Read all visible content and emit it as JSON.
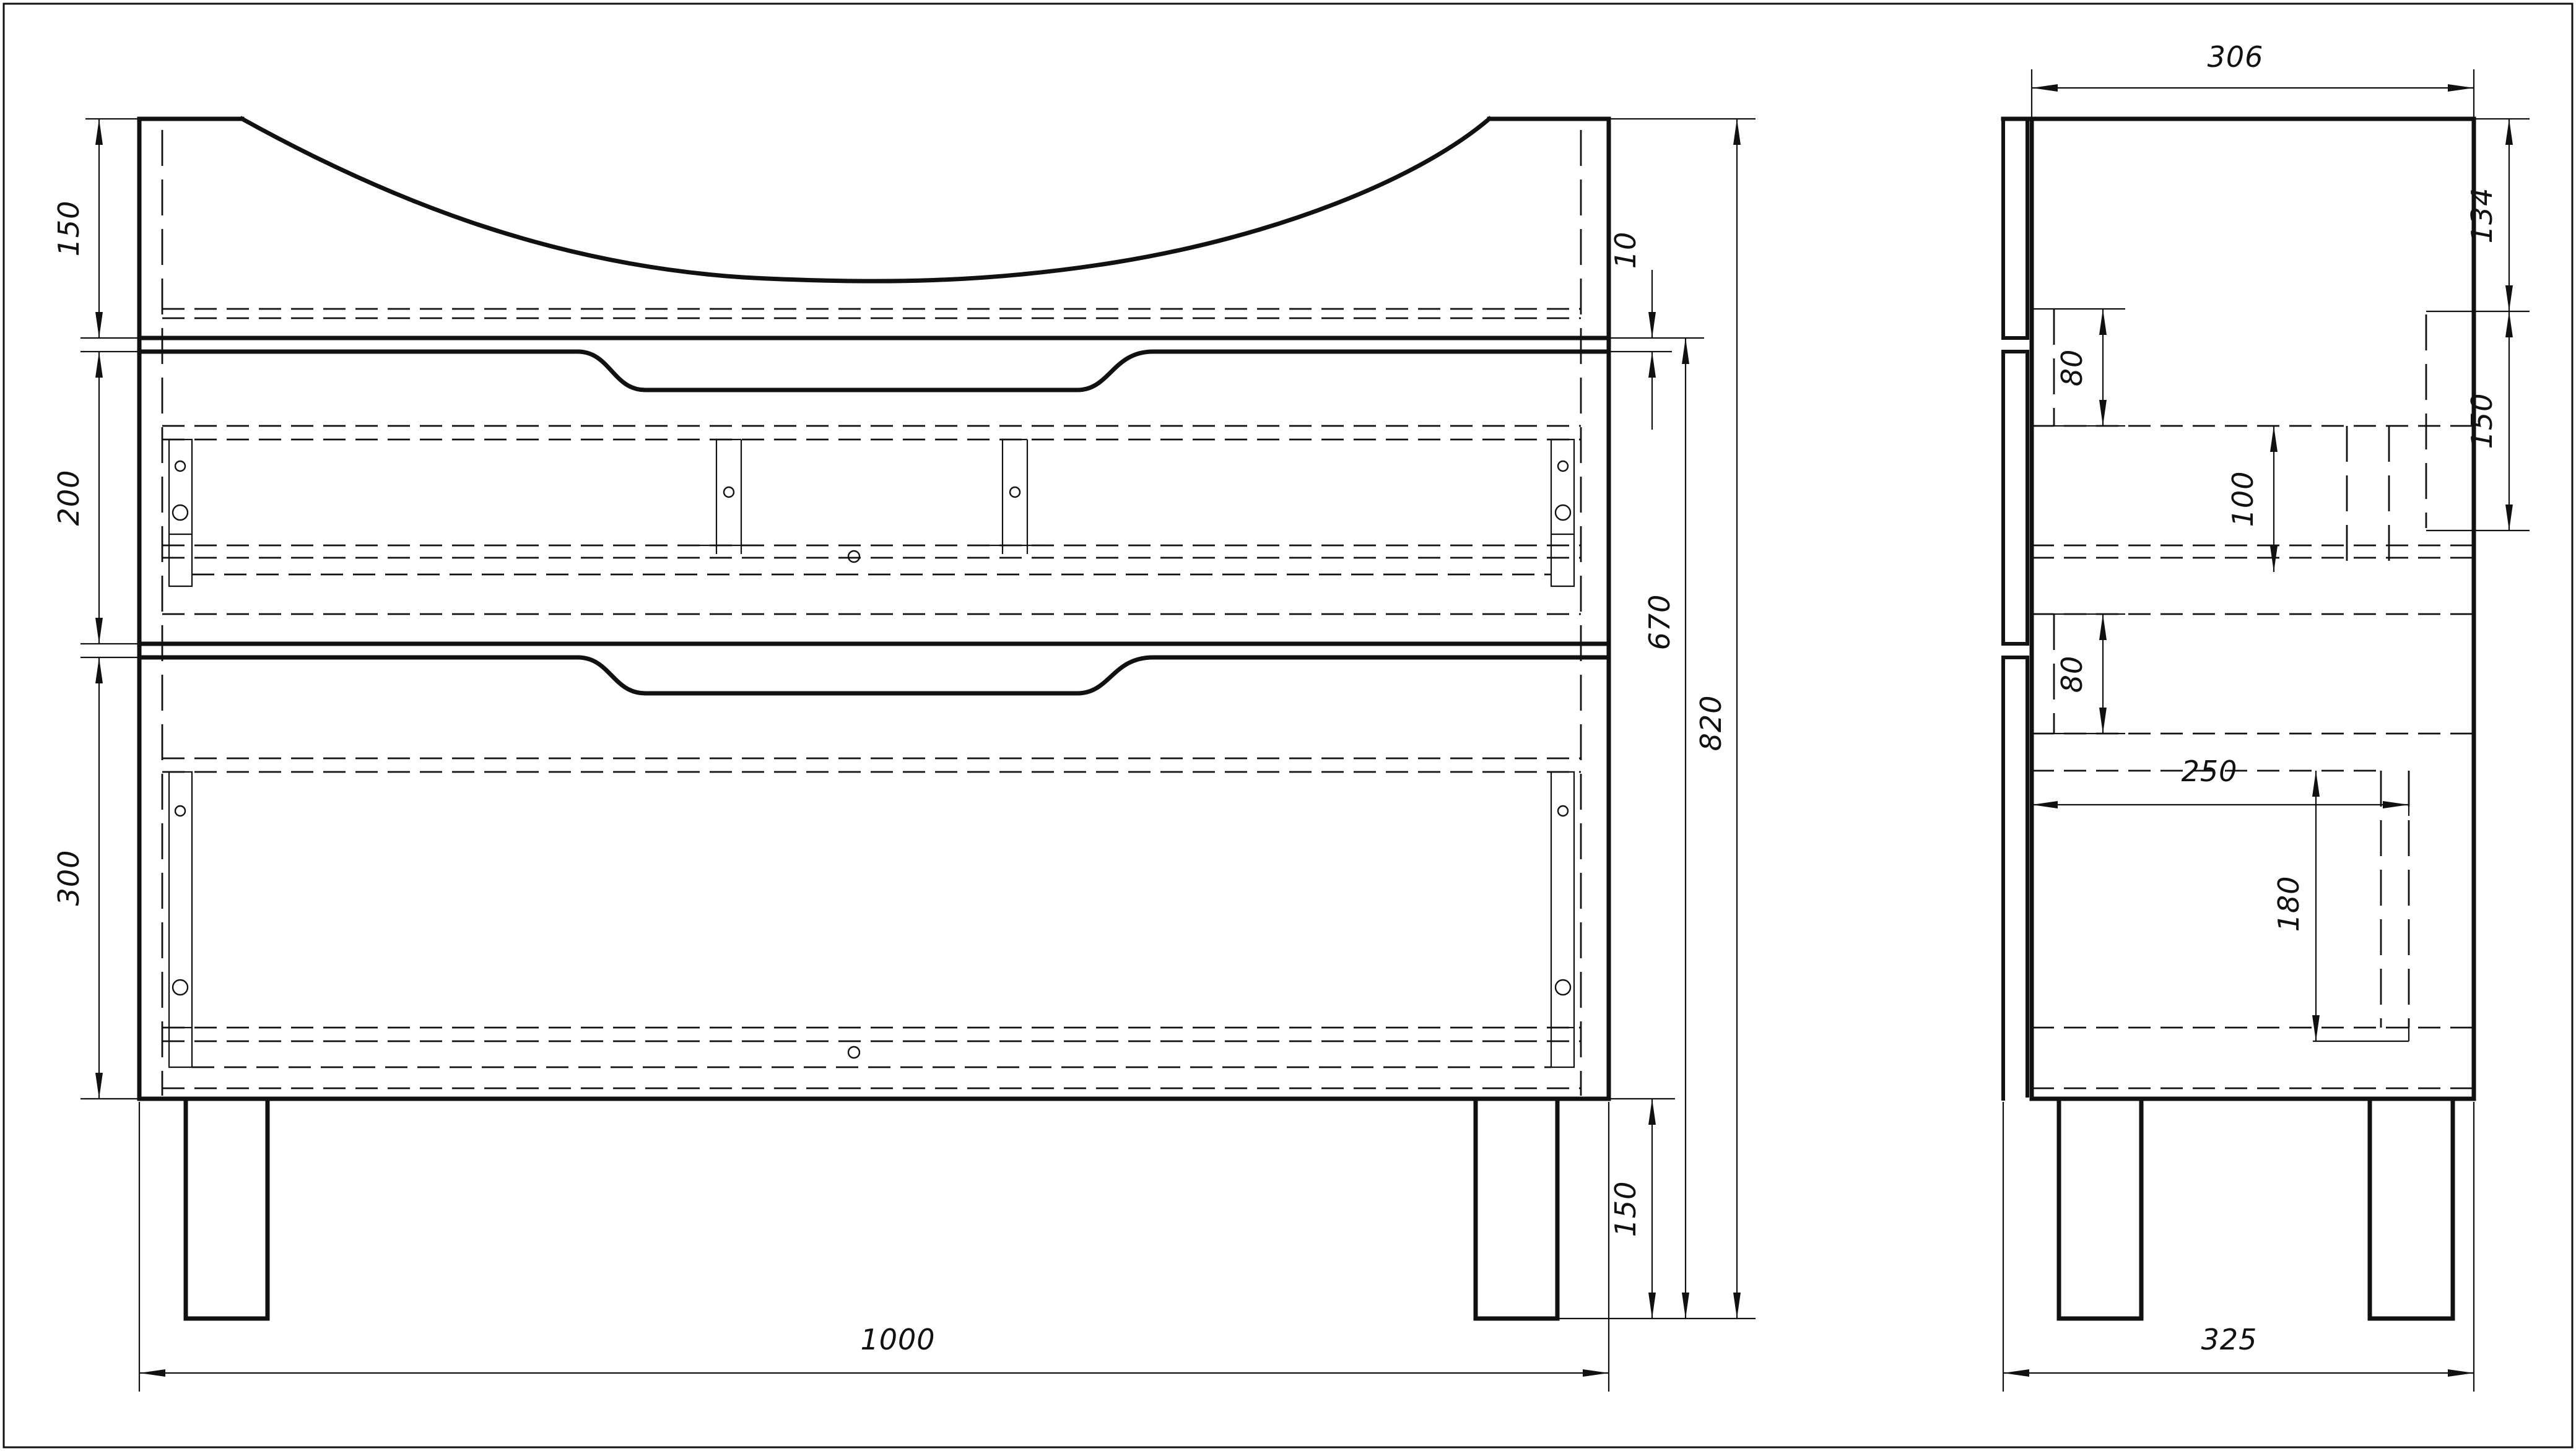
{
  "sheet": {
    "background": "#ffffff",
    "line_color": "#111111",
    "description": "Two-view engineering drawing of a vanity cabinet with curved sink top, two drawers and four legs"
  },
  "front_view": {
    "dims": {
      "top_section_height": "150",
      "reveal_gap": "10",
      "drawer1_height": "200",
      "drawer2_height": "300",
      "carcass_height": "670",
      "overall_height": "820",
      "leg_height": "150",
      "overall_width": "1000"
    }
  },
  "side_view": {
    "dims": {
      "overall_depth": "306",
      "top_to_shelf": "134",
      "shelf_to_rail": "150",
      "upper_rail_offset": "80",
      "rail_height": "100",
      "lower_rail_offset": "80",
      "drawer_inner_depth": "250",
      "lower_rail_height": "180",
      "base_depth": "325"
    }
  }
}
